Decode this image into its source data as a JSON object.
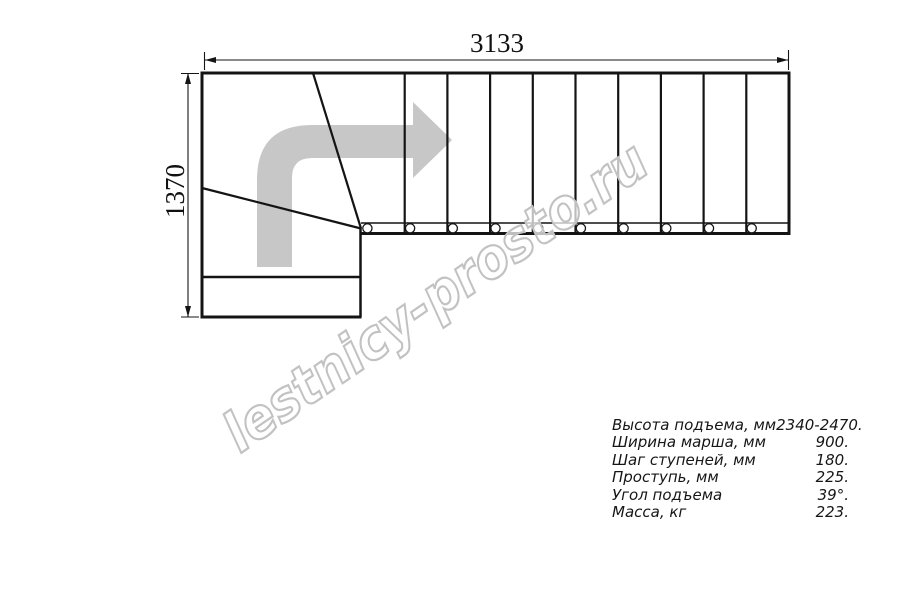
{
  "drawing": {
    "width_dim": "3133",
    "height_dim": "1370",
    "watermark": "lestnicy-prosto.ru"
  },
  "specs": {
    "rows": [
      {
        "label": "Высота подъема, мм",
        "value": "2340-2470."
      },
      {
        "label": "Ширина марша, мм",
        "value": "900."
      },
      {
        "label": "Шаг ступеней, мм",
        "value": "180."
      },
      {
        "label": "Проступь, мм",
        "value": "225."
      },
      {
        "label": "Угол подъема",
        "value": "39°."
      },
      {
        "label": "Масса, кг",
        "value": "223."
      }
    ]
  },
  "colors": {
    "line": "#141414",
    "direction_arrow": "#c7c7c7",
    "watermark_outline": "#c2c2c2"
  }
}
